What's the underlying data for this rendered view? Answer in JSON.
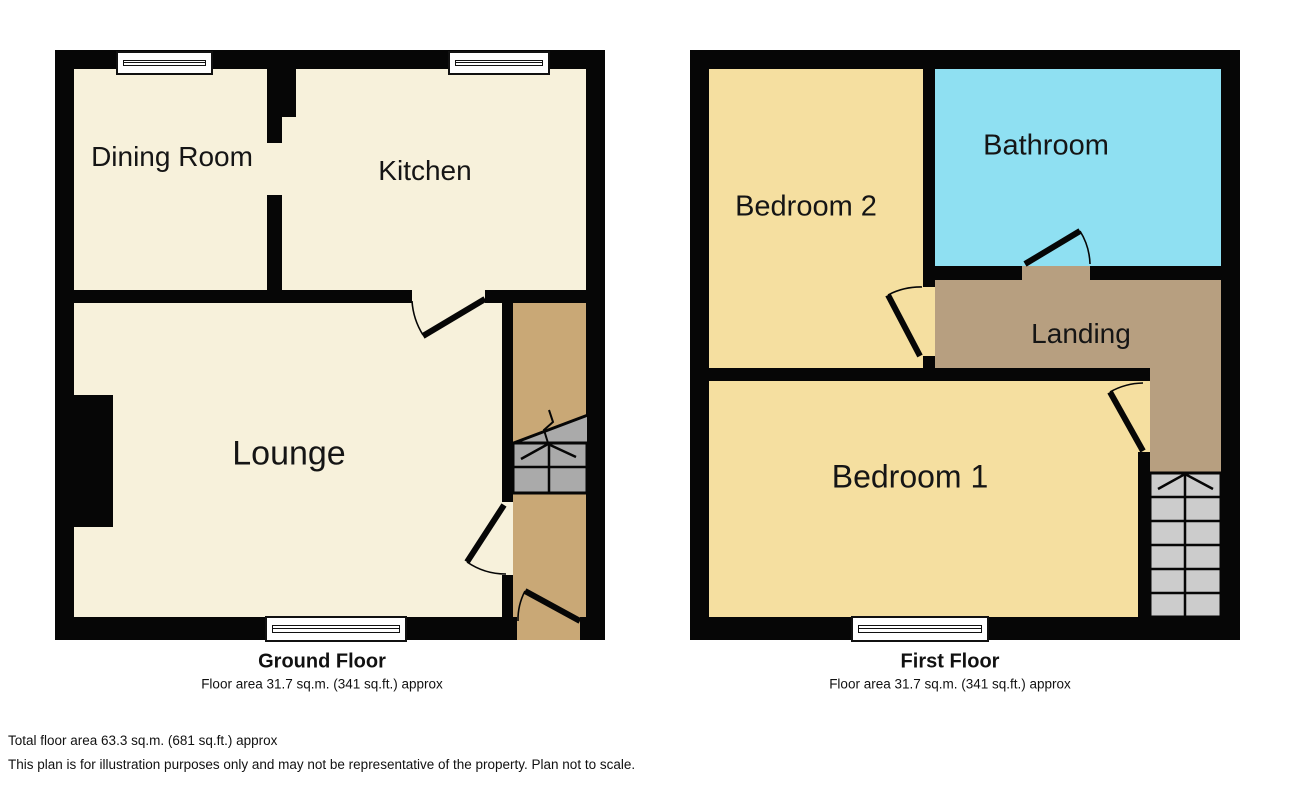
{
  "ground_floor": {
    "title": "Ground Floor",
    "area_note": "Floor area 31.7 sq.m. (341 sq.ft.) approx",
    "rooms": {
      "dining": "Dining Room",
      "kitchen": "Kitchen",
      "lounge": "Lounge"
    }
  },
  "first_floor": {
    "title": "First Floor",
    "area_note": "Floor area 31.7 sq.m. (341 sq.ft.) approx",
    "rooms": {
      "bedroom2": "Bedroom 2",
      "bathroom": "Bathroom",
      "landing": "Landing",
      "bedroom1": "Bedroom 1"
    }
  },
  "footer": {
    "total_area": "Total floor area 63.3 sq.m. (681 sq.ft.) approx",
    "disclaimer": "This plan is for illustration purposes only and may not be representative of the property. Plan not to scale."
  },
  "colors": {
    "cream": "#F7F1DB",
    "hall_tan": "#C9A876",
    "landing_tan": "#B79F80",
    "bedroom_yellow": "#F5DFA0",
    "bathroom_cyan": "#8FE0F2",
    "stairs_gray_ground": "#AAAAAA",
    "stairs_gray_first": "#CCCCCC",
    "wall_black": "#060606"
  }
}
